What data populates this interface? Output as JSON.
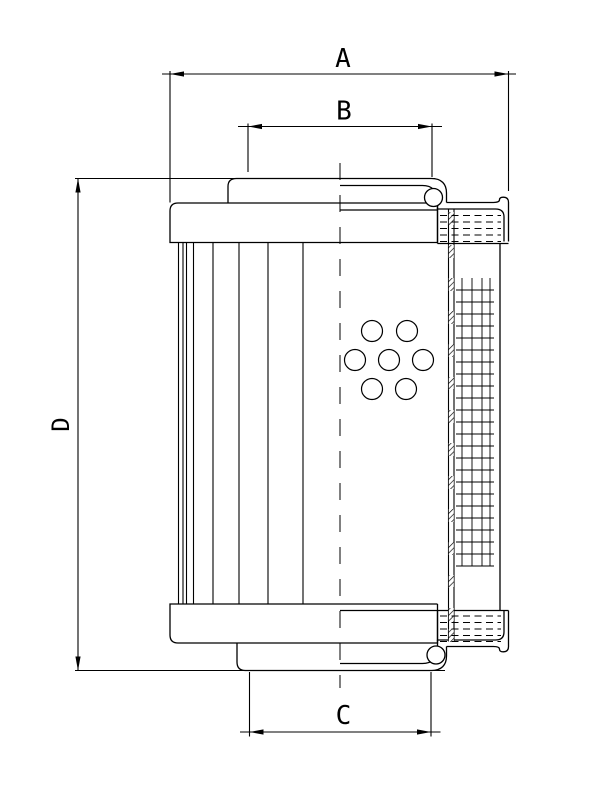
{
  "labels": {
    "A": "A",
    "B": "B",
    "C": "C",
    "D": "D"
  },
  "drawing": {
    "type": "technical-dimension-drawing",
    "subject": "filter-element-half-section",
    "background": "#ffffff",
    "line_color": "#000000",
    "dimensions": [
      {
        "id": "A",
        "axis": "x",
        "line": [
          162,
          74,
          516,
          74
        ],
        "tips": [
          [
            170,
            74,
            "left"
          ],
          [
            508.5,
            74,
            "right"
          ]
        ],
        "exts": [
          [
            170,
            71,
            170,
            202.5
          ],
          [
            508.5,
            71,
            508.5,
            191
          ]
        ]
      },
      {
        "id": "B",
        "axis": "x",
        "line": [
          238,
          126.5,
          442,
          126.5
        ],
        "tips": [
          [
            248,
            126.5,
            "left"
          ],
          [
            432,
            126.5,
            "right"
          ]
        ],
        "exts": [
          [
            248,
            123.5,
            248,
            172
          ],
          [
            432,
            123.5,
            432,
            177
          ]
        ]
      },
      {
        "id": "C",
        "axis": "x",
        "line": [
          240,
          732,
          440.5,
          732
        ],
        "tips": [
          [
            249.5,
            732,
            "left"
          ],
          [
            431,
            732,
            "right"
          ]
        ],
        "exts": [
          [
            249.5,
            672,
            249.5,
            736.5
          ],
          [
            431,
            672,
            431,
            736.5
          ]
        ]
      },
      {
        "id": "D",
        "axis": "y",
        "line": [
          78,
          178.5,
          78,
          670.5
        ],
        "tips": [
          [
            78,
            178.5,
            "up"
          ],
          [
            78,
            670.5,
            "down"
          ]
        ],
        "exts": []
      }
    ],
    "arrow": {
      "length": 14,
      "half_width": 2.6
    },
    "pleats": {
      "x": [
        178.5,
        183,
        186.5,
        193.5,
        213,
        239,
        268,
        303
      ],
      "y1": 242.5,
      "y2": 604
    },
    "holes": {
      "radius": 10.5,
      "centers": [
        [
          372,
          331
        ],
        [
          407,
          331
        ],
        [
          355,
          360
        ],
        [
          389,
          360
        ],
        [
          423,
          360
        ],
        [
          372,
          389
        ],
        [
          406,
          389
        ]
      ]
    },
    "mesh": {
      "vx": [
        462,
        472,
        482,
        490
      ],
      "vy1": 278,
      "vy2": 566,
      "hx1": 456,
      "hx2": 494,
      "hy1": 290,
      "hy2": 566,
      "hstep": 12
    },
    "gasket_dashes": {
      "x1": 440,
      "x2": 501,
      "dash": "7,4.5",
      "rows_top": [
        215.5,
        222,
        228.5,
        235,
        241.5
      ],
      "rows_bottom": [
        616,
        622.5,
        629,
        635.5,
        641.5
      ]
    },
    "hatch_strip": {
      "x": 448.8,
      "w": 5,
      "block_h": 13,
      "block_y": [
        212,
        245,
        278,
        311,
        344,
        377,
        410,
        443,
        476,
        509,
        542,
        575,
        608,
        629
      ]
    },
    "centerline": {
      "x": 340,
      "y1": 163,
      "y2": 688,
      "dash": "17,15"
    }
  }
}
